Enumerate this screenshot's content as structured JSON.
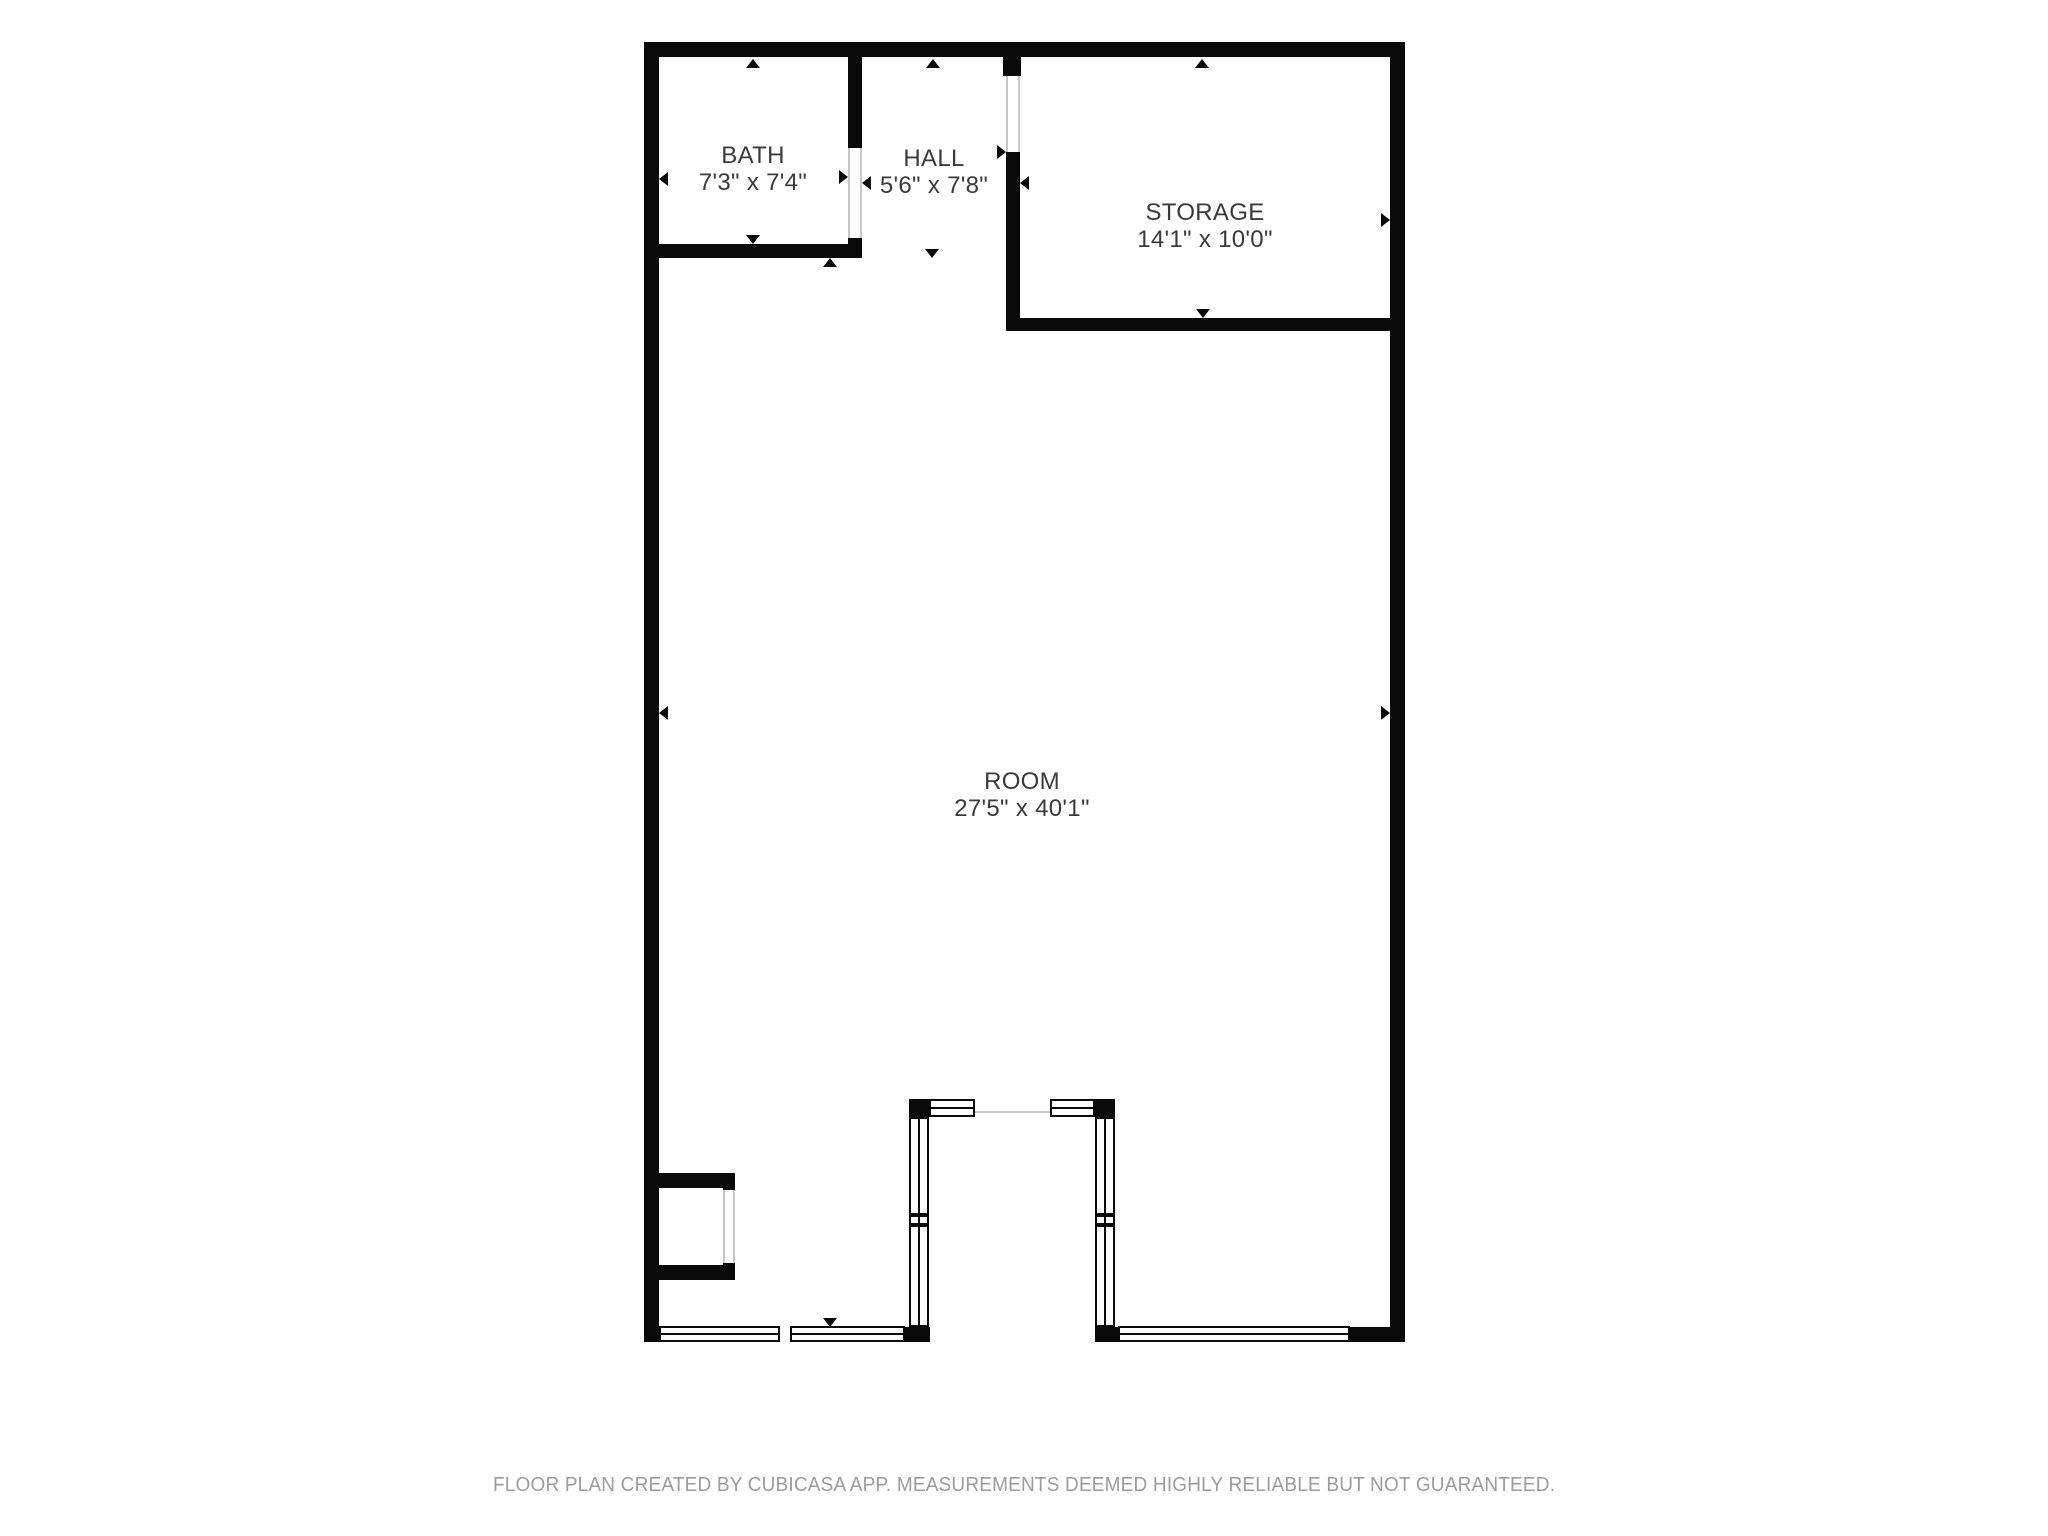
{
  "rooms": {
    "bath": {
      "name": "BATH",
      "dimensions": "7'3\" x 7'4\""
    },
    "hall": {
      "name": "HALL",
      "dimensions": "5'6\" x 7'8\""
    },
    "storage": {
      "name": "STORAGE",
      "dimensions": "14'1\" x 10'0\""
    },
    "room": {
      "name": "ROOM",
      "dimensions": "27'5\" x 40'1\""
    }
  },
  "footer": {
    "disclaimer": "FLOOR PLAN CREATED BY CUBICASA APP. MEASUREMENTS DEEMED HIGHLY RELIABLE BUT NOT GUARANTEED."
  },
  "colors": {
    "wall": "#0a0a0a",
    "label": "#3a3a3a",
    "footer": "#9b9b9b",
    "jamb": "#c6c6c6"
  }
}
